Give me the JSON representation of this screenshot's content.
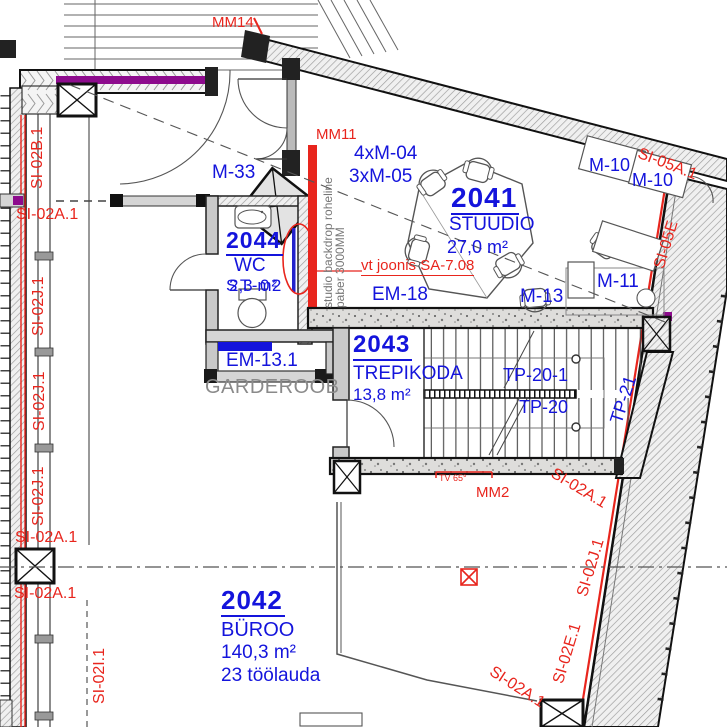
{
  "drawing_type": "architectural floor plan",
  "colors": {
    "annotation_red": "#e8251d",
    "label_blue": "#1414dc",
    "magenta_layer": "#8d0b8d",
    "wall_fill": "#d5d5d5",
    "speckle_fill": "#dedddb",
    "gray_text": "#8a8a8a"
  },
  "rooms": [
    {
      "number": "2041",
      "name": "STUUDIO",
      "area": "27,0 m²"
    },
    {
      "number": "2042",
      "name": "BÜROO",
      "area": "140,3 m²",
      "note": "23 töölauda"
    },
    {
      "number": "2043",
      "name": "TREPIKODA",
      "area": "13,8 m²"
    },
    {
      "number": "2044",
      "name": "WC",
      "area": "2,3 m²"
    }
  ],
  "zone_labels": {
    "garderoob": "GARDEROOB"
  },
  "furniture_tags": {
    "m33": "M-33",
    "m04": "4xM-04",
    "m05": "3xM-05",
    "m10": "M-10",
    "m11": "M-11",
    "m13": "M-13"
  },
  "element_tags": {
    "em18": "EM-18",
    "em13_1": "EM-13.1",
    "st02": "ST-02",
    "tp20_1": "TP-20-1",
    "tp20": "TP-20",
    "tp21": "TP-21"
  },
  "wall_tags": {
    "si02a1": "SI-02A.1",
    "si02b1": "SI-02B.1",
    "si02j1": "SI-02J.1",
    "si02i1": "SI-02I.1",
    "si02e1": "SI-02E.1",
    "si05a1": "SI-05A.1",
    "si05e": "SI-05E"
  },
  "site_markers": {
    "mm14": "MM14",
    "mm11": "MM11",
    "mm2": "MM2",
    "tv": "TV 65°"
  },
  "notes": {
    "reference": "vt joonis SA-7.08",
    "backdrop_line1": "studio backdrop roheline",
    "backdrop_line2": "paber 3000MM"
  }
}
